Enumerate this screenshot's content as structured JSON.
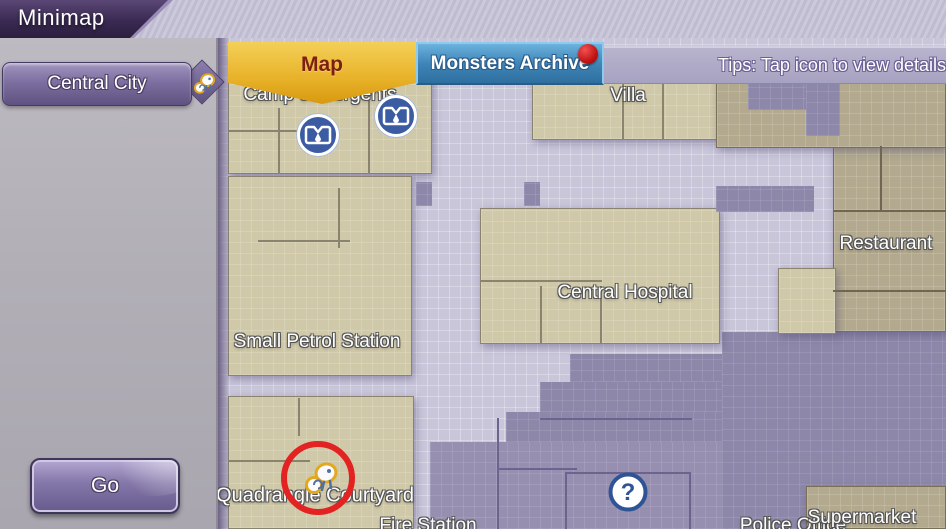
{
  "header": {
    "title": "Minimap"
  },
  "sidebar": {
    "region": {
      "label": "Central City"
    },
    "go_button": {
      "label": "Go"
    }
  },
  "tabs": {
    "map": {
      "label": "Map"
    },
    "monsters_archive": {
      "label": "Monsters Archive",
      "has_notification": true
    },
    "tips": {
      "label": "Tips: Tap icon to view details"
    }
  },
  "map": {
    "labels": {
      "camp_of_sergents": "Camp of Sergents",
      "villa": "Villa",
      "central_hospital": "Central Hospital",
      "restaurant": "Restaurant",
      "small_petrol_station": "Small Petrol Station",
      "quadrangle_courtyard": "Quadrangle Courtyard",
      "fire_station": "Fire Station",
      "police_office": "Police Office",
      "supermarket": "Supermarket"
    },
    "icons": {
      "monster_den": "monster-den-icon",
      "boss": "octopus-boss-icon",
      "question": "?",
      "selected_marker": "red-circle-highlight"
    }
  },
  "colors": {
    "tab_gold": "#e9b42c",
    "tab_blue": "#3f85b8",
    "notification_red": "#c31414",
    "street_lavender": "#c9c6da",
    "building_beige": "#d0c9a9",
    "building_tan": "#b2a98e",
    "zone_purple": "#8d87a9",
    "accent_purple": "#6f6193",
    "highlight_red": "#e32222",
    "icon_blue": "#3b5ca2"
  }
}
